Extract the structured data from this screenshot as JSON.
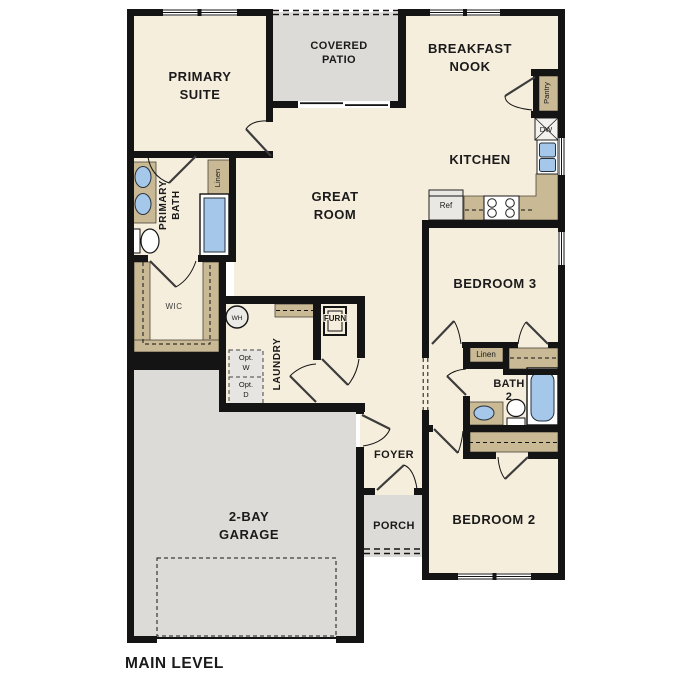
{
  "title": "MAIN LEVEL",
  "rooms": {
    "primary_suite": {
      "line1": "PRIMARY",
      "line2": "SUITE"
    },
    "covered_patio": {
      "line1": "COVERED",
      "line2": "PATIO"
    },
    "breakfast_nook": {
      "line1": "BREAKFAST",
      "line2": "NOOK"
    },
    "kitchen": {
      "label": "KITCHEN"
    },
    "great_room": {
      "line1": "GREAT",
      "line2": "ROOM"
    },
    "primary_bath": {
      "line1": "PRIMARY",
      "line2": "BATH"
    },
    "wic": {
      "label": "WIC"
    },
    "laundry": {
      "label": "LAUNDRY"
    },
    "furnace": {
      "label": "FURN"
    },
    "bedroom3": {
      "label": "BEDROOM 3"
    },
    "bath2": {
      "line1": "BATH",
      "line2": "2"
    },
    "bedroom2": {
      "label": "BEDROOM 2"
    },
    "foyer": {
      "label": "FOYER"
    },
    "porch": {
      "label": "PORCH"
    },
    "garage": {
      "line1": "2-BAY",
      "line2": "GARAGE"
    }
  },
  "fixtures": {
    "pantry": "Pantry",
    "dishwasher": "DW",
    "refrigerator": "Ref",
    "water_heater": "WH",
    "linen_primary": "Linen",
    "linen_hall": "Linen",
    "opt_washer": {
      "line1": "Opt.",
      "line2": "W"
    },
    "opt_dryer": {
      "line1": "Opt.",
      "line2": "D"
    }
  },
  "colors": {
    "floor": "#f6eedd",
    "wall": "#141414",
    "casework_tan": "#c9b995",
    "fixture_blue": "#a5c7e9",
    "concrete_gray": "#dcdbd7",
    "appliance_gray": "#e9e8e3",
    "text": "#1a1a1a"
  }
}
